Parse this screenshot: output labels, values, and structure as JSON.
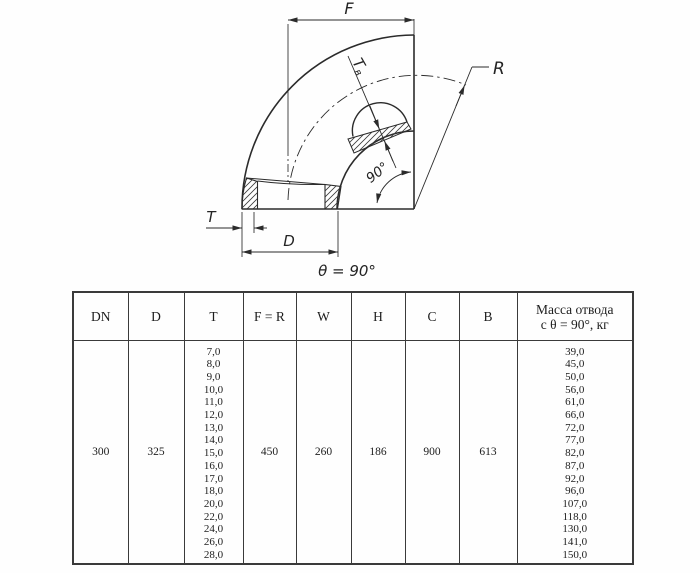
{
  "drawing": {
    "dim_f": "F",
    "dim_r": "R",
    "dim_t": "T",
    "dim_d": "D",
    "dim_tv_main": "T",
    "dim_tv_sub": "в",
    "angle_label": "90°",
    "caption": "θ = 90°"
  },
  "table": {
    "headers": {
      "dn": "DN",
      "d": "D",
      "t": "T",
      "fr": "F = R",
      "w": "W",
      "h": "H",
      "c": "C",
      "b": "B",
      "mass_line1": "Масса отвода",
      "mass_line2": "с θ =  90°, кг"
    },
    "row": {
      "dn": "300",
      "d": "325",
      "fr": "450",
      "w": "260",
      "h": "186",
      "c": "900",
      "b": "613"
    },
    "t_values": [
      "7,0",
      "8,0",
      "9,0",
      "10,0",
      "11,0",
      "12,0",
      "13,0",
      "14,0",
      "15,0",
      "16,0",
      "17,0",
      "18,0",
      "20,0",
      "22,0",
      "24,0",
      "26,0",
      "28,0"
    ],
    "mass_values": [
      "39,0",
      "45,0",
      "50,0",
      "56,0",
      "61,0",
      "66,0",
      "72,0",
      "77,0",
      "82,0",
      "87,0",
      "92,0",
      "96,0",
      "107,0",
      "118,0",
      "130,0",
      "141,0",
      "150,0"
    ]
  }
}
